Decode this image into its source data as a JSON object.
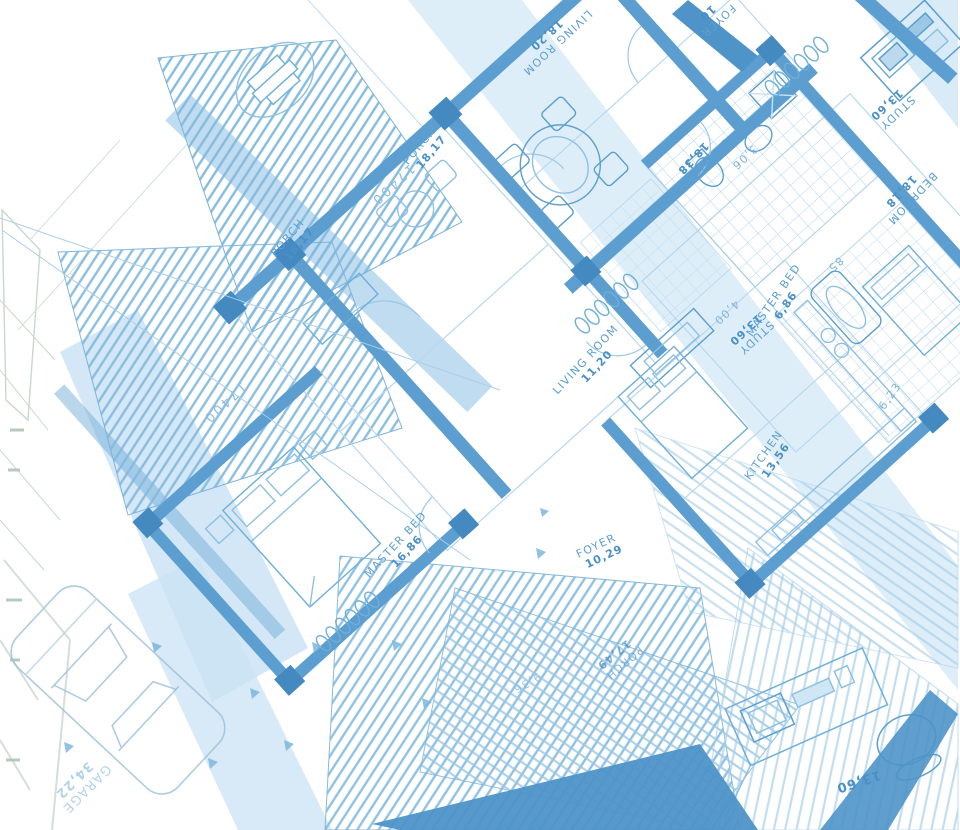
{
  "title": "Architectural blueprint floor plan (rotated blue line drawing on white)",
  "colors": {
    "background": "#ffffff",
    "wall_blue": "#5b9ecf",
    "wall_dark": "#4489c0",
    "line_light": "#9cc8e6",
    "line_faint": "#c7e1f3",
    "fill_light": "#d9eaf6",
    "site_plan_green": "#9fb7a4",
    "label_blue": "#5d9fd3"
  },
  "labels": {
    "living_room_top": {
      "name": "LIVING ROOM",
      "value": "18,20"
    },
    "foyer_top": {
      "name": "FOYER",
      "value": "10"
    },
    "bedroom_top": {
      "name": "BEDROOM",
      "value": "18,38"
    },
    "study_top_right": {
      "name": "STUDY",
      "value": "13,60"
    },
    "dim_4_00": "4,00",
    "study_right_edge": {
      "name": "STUDY",
      "value": "13,60"
    },
    "bedroom_right_edge": {
      "name": "BEDROOM",
      "value": "18,18"
    },
    "dim_3_06": "3,06",
    "master_bed_right": {
      "name": "MASTER BED",
      "value": "6,86"
    },
    "dim_85": "85",
    "kitchen": {
      "name": "KITCHEN",
      "value": "13,56"
    },
    "living_room_center": {
      "name": "LIVING ROOM",
      "value": "11,20"
    },
    "porch_upper_a": {
      "name": "PORCH",
      "value": "18,17"
    },
    "porch_upper_b": {
      "name": "PORCH",
      "value": "18,17"
    },
    "dim_17400_top": "17400",
    "dim_17400_left": "17400",
    "master_bed_left": {
      "name": "MASTER BED",
      "value": "16,86"
    },
    "foyer_center": {
      "name": "FOYER",
      "value": "10,29"
    },
    "porch_bottom": {
      "name": "PORCH",
      "value": "17,49"
    },
    "dim_9_36": "9,36",
    "study_bottom": {
      "name": "STUDY",
      "value": "13,60"
    },
    "garage": {
      "name": "GARAGE",
      "value": "34,22"
    },
    "dim_6_23": "6,23"
  }
}
